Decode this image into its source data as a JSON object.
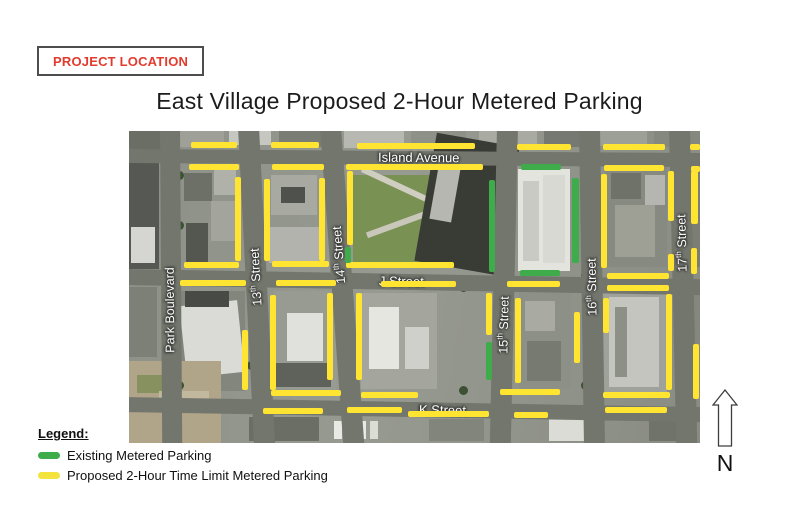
{
  "project_location": {
    "label": "PROJECT LOCATION",
    "text_color": "#e23b2d",
    "border_color": "#4d4d4d"
  },
  "title": "East Village Proposed 2-Hour Metered Parking",
  "north": {
    "label": "N"
  },
  "legend": {
    "heading": "Legend:",
    "items": [
      {
        "id": "existing",
        "label": "Existing Metered Parking",
        "color": "#3eac4b"
      },
      {
        "id": "proposed",
        "label": "Proposed 2-Hour Time Limit Metered Parking",
        "color": "#f2e43c"
      }
    ]
  },
  "map": {
    "colors": {
      "proposed": "#ffe431",
      "existing": "#3eac4b",
      "road": "#73766d"
    },
    "roads": {
      "horizontal": [
        {
          "id": "island-avenue",
          "label": "Island Avenue",
          "y": 18,
          "h": 14,
          "tilt": 0.4,
          "label_x": 255
        },
        {
          "id": "j-street",
          "label": "J Street",
          "y": 138,
          "h": 16,
          "tilt": 1.0,
          "label_x": 256
        },
        {
          "id": "k-street",
          "label": "K Street",
          "y": 266,
          "h": 15,
          "tilt": 1.0,
          "label_x": 296
        }
      ],
      "vertical": [
        {
          "id": "park-boulevard",
          "label": "Park Boulevard",
          "cx": 41,
          "w": 20,
          "skew": 0.4,
          "label_cx": 41,
          "label_cy": 179
        },
        {
          "id": "13th-street",
          "label": "13th Street",
          "cx": 119,
          "w": 21,
          "skew": 2.9,
          "label_cx": 127,
          "label_cy": 146
        },
        {
          "id": "14th-street",
          "label": "14th Street",
          "cx": 201,
          "w": 21,
          "skew": 4.2,
          "label_cx": 210,
          "label_cy": 124
        },
        {
          "id": "15th-street",
          "label": "15th Street",
          "cx": 378,
          "w": 21,
          "skew": -1.3,
          "label_cx": 375,
          "label_cy": 194
        },
        {
          "id": "16th-street",
          "label": "16th Street",
          "cx": 460,
          "w": 21,
          "skew": 0.9,
          "label_cx": 463,
          "label_cy": 156
        },
        {
          "id": "17th-street",
          "label": "17th Street",
          "cx": 550,
          "w": 21,
          "skew": 1.3,
          "label_cx": 553,
          "label_cy": 112
        }
      ]
    },
    "segments": [
      {
        "t": "proposed",
        "x": 62,
        "y": 11,
        "w": 46,
        "h": 6
      },
      {
        "t": "proposed",
        "x": 142,
        "y": 11,
        "w": 48,
        "h": 6
      },
      {
        "t": "proposed",
        "x": 228,
        "y": 12,
        "w": 118,
        "h": 6
      },
      {
        "t": "proposed",
        "x": 388,
        "y": 13,
        "w": 54,
        "h": 6
      },
      {
        "t": "proposed",
        "x": 474,
        "y": 13,
        "w": 62,
        "h": 6
      },
      {
        "t": "proposed",
        "x": 561,
        "y": 13,
        "w": 10,
        "h": 6
      },
      {
        "t": "proposed",
        "x": 60,
        "y": 33,
        "w": 50,
        "h": 6
      },
      {
        "t": "proposed",
        "x": 143,
        "y": 33,
        "w": 52,
        "h": 6
      },
      {
        "t": "proposed",
        "x": 217,
        "y": 33,
        "w": 137,
        "h": 6
      },
      {
        "t": "existing",
        "x": 392,
        "y": 33,
        "w": 40,
        "h": 6
      },
      {
        "t": "proposed",
        "x": 475,
        "y": 34,
        "w": 60,
        "h": 6
      },
      {
        "t": "proposed",
        "x": 562,
        "y": 35,
        "w": 9,
        "h": 6
      },
      {
        "t": "proposed",
        "x": 55,
        "y": 131,
        "w": 55,
        "h": 6
      },
      {
        "t": "proposed",
        "x": 143,
        "y": 130,
        "w": 57,
        "h": 6
      },
      {
        "t": "proposed",
        "x": 217,
        "y": 131,
        "w": 108,
        "h": 6
      },
      {
        "t": "existing",
        "x": 391,
        "y": 139,
        "w": 40,
        "h": 6
      },
      {
        "t": "proposed",
        "x": 478,
        "y": 142,
        "w": 62,
        "h": 6
      },
      {
        "t": "proposed",
        "x": 51,
        "y": 149,
        "w": 66,
        "h": 6
      },
      {
        "t": "proposed",
        "x": 147,
        "y": 149,
        "w": 60,
        "h": 6
      },
      {
        "t": "proposed",
        "x": 252,
        "y": 150,
        "w": 75,
        "h": 6
      },
      {
        "t": "proposed",
        "x": 378,
        "y": 150,
        "w": 53,
        "h": 6
      },
      {
        "t": "proposed",
        "x": 478,
        "y": 154,
        "w": 62,
        "h": 6
      },
      {
        "t": "proposed",
        "x": 142,
        "y": 259,
        "w": 70,
        "h": 6
      },
      {
        "t": "proposed",
        "x": 232,
        "y": 261,
        "w": 57,
        "h": 6
      },
      {
        "t": "proposed",
        "x": 371,
        "y": 258,
        "w": 60,
        "h": 6
      },
      {
        "t": "proposed",
        "x": 474,
        "y": 261,
        "w": 67,
        "h": 6
      },
      {
        "t": "proposed",
        "x": 134,
        "y": 277,
        "w": 60,
        "h": 6
      },
      {
        "t": "proposed",
        "x": 218,
        "y": 276,
        "w": 55,
        "h": 6
      },
      {
        "t": "proposed",
        "x": 279,
        "y": 280,
        "w": 81,
        "h": 6
      },
      {
        "t": "proposed",
        "x": 385,
        "y": 281,
        "w": 34,
        "h": 6
      },
      {
        "t": "proposed",
        "x": 476,
        "y": 276,
        "w": 62,
        "h": 6
      },
      {
        "t": "proposed",
        "x": 106,
        "y": 46,
        "w": 6,
        "h": 84
      },
      {
        "t": "proposed",
        "x": 135,
        "y": 48,
        "w": 6,
        "h": 82
      },
      {
        "t": "proposed",
        "x": 190,
        "y": 47,
        "w": 6,
        "h": 83
      },
      {
        "t": "proposed",
        "x": 218,
        "y": 40,
        "w": 6,
        "h": 74
      },
      {
        "t": "existing",
        "x": 216,
        "y": 116,
        "w": 6,
        "h": 16
      },
      {
        "t": "existing",
        "x": 360,
        "y": 49,
        "w": 6,
        "h": 92
      },
      {
        "t": "existing",
        "x": 443,
        "y": 47,
        "w": 7,
        "h": 85
      },
      {
        "t": "proposed",
        "x": 472,
        "y": 43,
        "w": 6,
        "h": 94
      },
      {
        "t": "proposed",
        "x": 539,
        "y": 40,
        "w": 6,
        "h": 50
      },
      {
        "t": "proposed",
        "x": 539,
        "y": 123,
        "w": 6,
        "h": 17
      },
      {
        "t": "proposed",
        "x": 562,
        "y": 40,
        "w": 7,
        "h": 53
      },
      {
        "t": "proposed",
        "x": 562,
        "y": 117,
        "w": 6,
        "h": 26
      },
      {
        "t": "proposed",
        "x": 113,
        "y": 199,
        "w": 6,
        "h": 60
      },
      {
        "t": "proposed",
        "x": 141,
        "y": 164,
        "w": 6,
        "h": 95
      },
      {
        "t": "proposed",
        "x": 198,
        "y": 162,
        "w": 6,
        "h": 87
      },
      {
        "t": "proposed",
        "x": 227,
        "y": 162,
        "w": 6,
        "h": 87
      },
      {
        "t": "proposed",
        "x": 357,
        "y": 162,
        "w": 6,
        "h": 42
      },
      {
        "t": "existing",
        "x": 357,
        "y": 211,
        "w": 6,
        "h": 38
      },
      {
        "t": "proposed",
        "x": 386,
        "y": 167,
        "w": 6,
        "h": 85
      },
      {
        "t": "proposed",
        "x": 445,
        "y": 181,
        "w": 6,
        "h": 51
      },
      {
        "t": "proposed",
        "x": 474,
        "y": 167,
        "w": 6,
        "h": 35
      },
      {
        "t": "proposed",
        "x": 537,
        "y": 163,
        "w": 6,
        "h": 96
      },
      {
        "t": "proposed",
        "x": 564,
        "y": 213,
        "w": 6,
        "h": 55
      }
    ]
  }
}
